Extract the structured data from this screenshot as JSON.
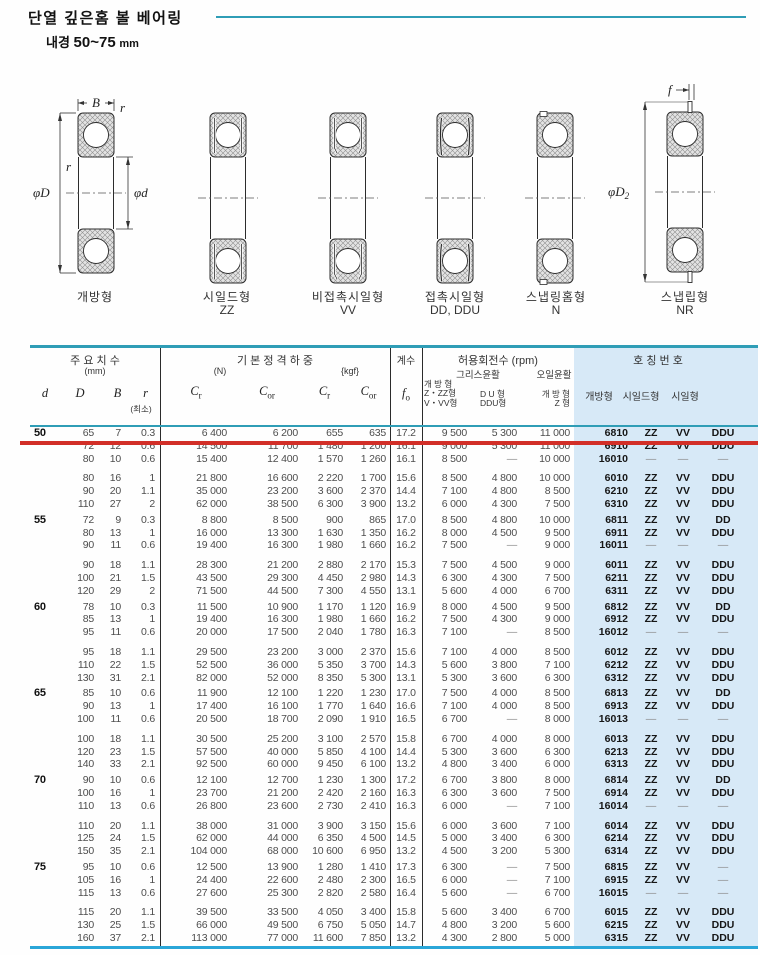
{
  "page": {
    "title": "단열 깊은홈 볼 베어링",
    "subtitle_label": "내경",
    "subtitle_range": "50~75",
    "subtitle_unit": "mm"
  },
  "diagrams": {
    "dims": {
      "B": "B",
      "r": "r",
      "phiD": "φD",
      "phid": "φd",
      "f": "f",
      "phiD2_sym": "φD",
      "phiD2_sub": "2"
    },
    "types": [
      {
        "label": "개방형",
        "code": ""
      },
      {
        "label": "시일드형",
        "code": "ZZ"
      },
      {
        "label": "비접촉시일형",
        "code": "VV"
      },
      {
        "label": "접촉시일형",
        "code": "DD, DDU"
      },
      {
        "label": "스냅링홈형",
        "code": "N"
      },
      {
        "label": "스냅립형",
        "code": "NR"
      }
    ]
  },
  "table": {
    "header": {
      "dims_title": "주 요 치 수",
      "dims_unit": "(mm)",
      "col_d": "d",
      "col_D": "D",
      "col_B": "B",
      "col_r": "r",
      "col_r_min": "(최소)",
      "load_title": "기 본 정 격 하 중",
      "unit_n": "(N)",
      "unit_kgf": "{kgf}",
      "c_sym": "C",
      "cr_sub": "r",
      "cor_sub": "or",
      "factor_title": "계수",
      "fo_sym": "f",
      "fo_sub": "o",
      "speed_title": "허용회전수 (rpm)",
      "grease": "그리스윤활",
      "oil": "오일윤활",
      "g1_lines": [
        "개 방 형",
        "Z・ZZ형",
        "V・VV형"
      ],
      "g2_lines": [
        "D U 형",
        "DDU형"
      ],
      "oil_lines": [
        "개 방 형",
        "Z 형"
      ],
      "part_title": "호 칭 번 호",
      "part_cols": [
        "개방형",
        "시일드형",
        "시일형"
      ]
    },
    "groups": [
      {
        "d": "50",
        "rows_a": [
          [
            "65",
            "7",
            "0.3",
            "6 400",
            "6 200",
            "655",
            "635",
            "17.2",
            "9 500",
            "5 300",
            "11 000",
            "6810",
            "ZZ",
            "VV",
            "DDU"
          ],
          [
            "72",
            "12",
            "0.6",
            "14 500",
            "11 700",
            "1 480",
            "1 200",
            "16.1",
            "9 000",
            "5 300",
            "11 000",
            "6910",
            "ZZ",
            "VV",
            "DDU"
          ],
          [
            "80",
            "10",
            "0.6",
            "15 400",
            "12 400",
            "1 570",
            "1 260",
            "16.1",
            "8 500",
            "—",
            "10 000",
            "16010",
            "—",
            "—",
            "—"
          ]
        ],
        "rows_b": [
          [
            "80",
            "16",
            "1",
            "21 800",
            "16 600",
            "2 220",
            "1 700",
            "15.6",
            "8 500",
            "4 800",
            "10 000",
            "6010",
            "ZZ",
            "VV",
            "DDU"
          ],
          [
            "90",
            "20",
            "1.1",
            "35 000",
            "23 200",
            "3 600",
            "2 370",
            "14.4",
            "7 100",
            "4 800",
            "8 500",
            "6210",
            "ZZ",
            "VV",
            "DDU"
          ],
          [
            "110",
            "27",
            "2",
            "62 000",
            "38 500",
            "6 300",
            "3 900",
            "13.2",
            "6 000",
            "4 300",
            "7 500",
            "6310",
            "ZZ",
            "VV",
            "DDU"
          ]
        ]
      },
      {
        "d": "55",
        "rows_a": [
          [
            "72",
            "9",
            "0.3",
            "8 800",
            "8 500",
            "900",
            "865",
            "17.0",
            "8 500",
            "4 800",
            "10 000",
            "6811",
            "ZZ",
            "VV",
            "DD"
          ],
          [
            "80",
            "13",
            "1",
            "16 000",
            "13 300",
            "1 630",
            "1 350",
            "16.2",
            "8 000",
            "4 500",
            "9 500",
            "6911",
            "ZZ",
            "VV",
            "DDU"
          ],
          [
            "90",
            "11",
            "0.6",
            "19 400",
            "16 300",
            "1 980",
            "1 660",
            "16.2",
            "7 500",
            "—",
            "9 000",
            "16011",
            "—",
            "—",
            "—"
          ]
        ],
        "rows_b": [
          [
            "90",
            "18",
            "1.1",
            "28 300",
            "21 200",
            "2 880",
            "2 170",
            "15.3",
            "7 500",
            "4 500",
            "9 000",
            "6011",
            "ZZ",
            "VV",
            "DDU"
          ],
          [
            "100",
            "21",
            "1.5",
            "43 500",
            "29 300",
            "4 450",
            "2 980",
            "14.3",
            "6 300",
            "4 300",
            "7 500",
            "6211",
            "ZZ",
            "VV",
            "DDU"
          ],
          [
            "120",
            "29",
            "2",
            "71 500",
            "44 500",
            "7 300",
            "4 550",
            "13.1",
            "5 600",
            "4 000",
            "6 700",
            "6311",
            "ZZ",
            "VV",
            "DDU"
          ]
        ]
      },
      {
        "d": "60",
        "rows_a": [
          [
            "78",
            "10",
            "0.3",
            "11 500",
            "10 900",
            "1 170",
            "1 120",
            "16.9",
            "8 000",
            "4 500",
            "9 500",
            "6812",
            "ZZ",
            "VV",
            "DD"
          ],
          [
            "85",
            "13",
            "1",
            "19 400",
            "16 300",
            "1 980",
            "1 660",
            "16.2",
            "7 500",
            "4 300",
            "9 000",
            "6912",
            "ZZ",
            "VV",
            "DDU"
          ],
          [
            "95",
            "11",
            "0.6",
            "20 000",
            "17 500",
            "2 040",
            "1 780",
            "16.3",
            "7 100",
            "—",
            "8 500",
            "16012",
            "—",
            "—",
            "—"
          ]
        ],
        "rows_b": [
          [
            "95",
            "18",
            "1.1",
            "29 500",
            "23 200",
            "3 000",
            "2 370",
            "15.6",
            "7 100",
            "4 000",
            "8 500",
            "6012",
            "ZZ",
            "VV",
            "DDU"
          ],
          [
            "110",
            "22",
            "1.5",
            "52 500",
            "36 000",
            "5 350",
            "3 700",
            "14.3",
            "5 600",
            "3 800",
            "7 100",
            "6212",
            "ZZ",
            "VV",
            "DDU"
          ],
          [
            "130",
            "31",
            "2.1",
            "82 000",
            "52 000",
            "8 350",
            "5 300",
            "13.1",
            "5 300",
            "3 600",
            "6 300",
            "6312",
            "ZZ",
            "VV",
            "DDU"
          ]
        ]
      },
      {
        "d": "65",
        "rows_a": [
          [
            "85",
            "10",
            "0.6",
            "11 900",
            "12 100",
            "1 220",
            "1 230",
            "17.0",
            "7 500",
            "4 000",
            "8 500",
            "6813",
            "ZZ",
            "VV",
            "DD"
          ],
          [
            "90",
            "13",
            "1",
            "17 400",
            "16 100",
            "1 770",
            "1 640",
            "16.6",
            "7 100",
            "4 000",
            "8 500",
            "6913",
            "ZZ",
            "VV",
            "DDU"
          ],
          [
            "100",
            "11",
            "0.6",
            "20 500",
            "18 700",
            "2 090",
            "1 910",
            "16.5",
            "6 700",
            "—",
            "8 000",
            "16013",
            "—",
            "—",
            "—"
          ]
        ],
        "rows_b": [
          [
            "100",
            "18",
            "1.1",
            "30 500",
            "25 200",
            "3 100",
            "2 570",
            "15.8",
            "6 700",
            "4 000",
            "8 000",
            "6013",
            "ZZ",
            "VV",
            "DDU"
          ],
          [
            "120",
            "23",
            "1.5",
            "57 500",
            "40 000",
            "5 850",
            "4 100",
            "14.4",
            "5 300",
            "3 600",
            "6 300",
            "6213",
            "ZZ",
            "VV",
            "DDU"
          ],
          [
            "140",
            "33",
            "2.1",
            "92 500",
            "60 000",
            "9 450",
            "6 100",
            "13.2",
            "4 800",
            "3 400",
            "6 000",
            "6313",
            "ZZ",
            "VV",
            "DDU"
          ]
        ]
      },
      {
        "d": "70",
        "rows_a": [
          [
            "90",
            "10",
            "0.6",
            "12 100",
            "12 700",
            "1 230",
            "1 300",
            "17.2",
            "6 700",
            "3 800",
            "8 000",
            "6814",
            "ZZ",
            "VV",
            "DD"
          ],
          [
            "100",
            "16",
            "1",
            "23 700",
            "21 200",
            "2 420",
            "2 160",
            "16.3",
            "6 300",
            "3 600",
            "7 500",
            "6914",
            "ZZ",
            "VV",
            "DDU"
          ],
          [
            "110",
            "13",
            "0.6",
            "26 800",
            "23 600",
            "2 730",
            "2 410",
            "16.3",
            "6 000",
            "—",
            "7 100",
            "16014",
            "—",
            "—",
            "—"
          ]
        ],
        "rows_b": [
          [
            "110",
            "20",
            "1.1",
            "38 000",
            "31 000",
            "3 900",
            "3 150",
            "15.6",
            "6 000",
            "3 600",
            "7 100",
            "6014",
            "ZZ",
            "VV",
            "DDU"
          ],
          [
            "125",
            "24",
            "1.5",
            "62 000",
            "44 000",
            "6 350",
            "4 500",
            "14.5",
            "5 000",
            "3 400",
            "6 300",
            "6214",
            "ZZ",
            "VV",
            "DDU"
          ],
          [
            "150",
            "35",
            "2.1",
            "104 000",
            "68 000",
            "10 600",
            "6 950",
            "13.2",
            "4 500",
            "3 200",
            "5 300",
            "6314",
            "ZZ",
            "VV",
            "DDU"
          ]
        ]
      },
      {
        "d": "75",
        "rows_a": [
          [
            "95",
            "10",
            "0.6",
            "12 500",
            "13 900",
            "1 280",
            "1 410",
            "17.3",
            "6 300",
            "—",
            "7 500",
            "6815",
            "ZZ",
            "VV",
            "—"
          ],
          [
            "105",
            "16",
            "1",
            "24 400",
            "22 600",
            "2 480",
            "2 300",
            "16.5",
            "6 000",
            "—",
            "7 100",
            "6915",
            "ZZ",
            "VV",
            "—"
          ],
          [
            "115",
            "13",
            "0.6",
            "27 600",
            "25 300",
            "2 820",
            "2 580",
            "16.4",
            "5 600",
            "—",
            "6 700",
            "16015",
            "—",
            "—",
            "—"
          ]
        ],
        "rows_b": [
          [
            "115",
            "20",
            "1.1",
            "39 500",
            "33 500",
            "4 050",
            "3 400",
            "15.8",
            "5 600",
            "3 400",
            "6 700",
            "6015",
            "ZZ",
            "VV",
            "DDU"
          ],
          [
            "130",
            "25",
            "1.5",
            "66 000",
            "49 500",
            "6 750",
            "5 050",
            "14.7",
            "4 800",
            "3 200",
            "5 600",
            "6215",
            "ZZ",
            "VV",
            "DDU"
          ],
          [
            "160",
            "37",
            "2.1",
            "113 000",
            "77 000",
            "11 600",
            "7 850",
            "13.2",
            "4 300",
            "2 800",
            "5 000",
            "6315",
            "ZZ",
            "VV",
            "DDU"
          ]
        ]
      }
    ]
  },
  "colors": {
    "teal": "#2f9db6",
    "cyan_line": "#2aa6d8",
    "light_blue": "#d7e9f7",
    "red": "#d22f28"
  }
}
